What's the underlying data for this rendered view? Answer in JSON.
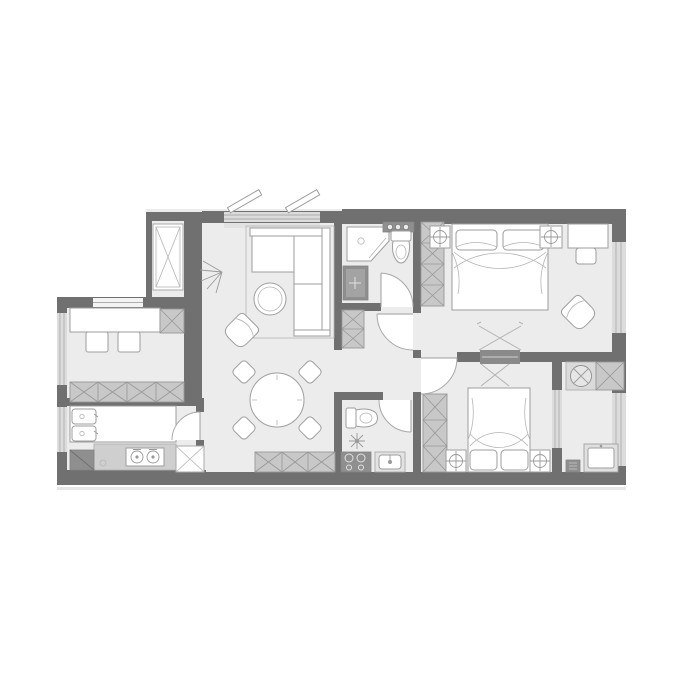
{
  "meta": {
    "title": "Apartment floor plan",
    "description": "Grayscale top-view architectural floor plan of a two-bedroom, two-bathroom apartment with living-dining area, study, kitchen and laundry balcony",
    "visible_text": []
  },
  "palette": {
    "background": "#ffffff",
    "wall": "#707070",
    "floor": "#ececec",
    "furniture_fill": "#ffffff",
    "furniture_stroke": "#9e9e9e",
    "cabinet_hatch_fill": "#c8c8c8",
    "cabinet_hatch_stroke": "#979797",
    "window_fill": "#dcdcdc",
    "window_line": "#adadad",
    "fixture_dark": "#8f8f8f",
    "counter_gray": "#cfcfcf"
  },
  "rooms": [
    {
      "id": "living-room",
      "position": "top-center-left",
      "furniture": [
        "corner-sofa",
        "coffee-table",
        "armchair",
        "floor-lamp",
        "casement-window-open-leaves"
      ]
    },
    {
      "id": "dining-area",
      "position": "center",
      "furniture": [
        "round-dining-table",
        "dining-chair-x4",
        "sideboard-hatched-cabinet"
      ]
    },
    {
      "id": "study",
      "position": "middle-left",
      "furniture": [
        "desk",
        "chair-x2",
        "desk-end-cabinet",
        "storage-cabinet-row"
      ]
    },
    {
      "id": "kitchen",
      "position": "bottom-left",
      "furniture": [
        "double-sink",
        "upper-counter",
        "lower-counter",
        "two-burner-cooktop",
        "corner-cabinet",
        "fridge-cabinet",
        "door"
      ]
    },
    {
      "id": "entry-closet",
      "position": "top-left",
      "furniture": [
        "tall-wardrobe-x-cabinet"
      ]
    },
    {
      "id": "bathroom-1",
      "position": "top-center",
      "furniture": [
        "corner-shower",
        "toilet",
        "vanity-washbasin",
        "wash-counter-with-bowls",
        "door"
      ]
    },
    {
      "id": "bedroom-1",
      "position": "top-right",
      "furniture": [
        "double-bed",
        "nightstand-with-lamp-x2",
        "hatched-wardrobe",
        "desk",
        "desk-chair",
        "lounge-chair",
        "ceiling-light-cross"
      ]
    },
    {
      "id": "bedroom-2",
      "position": "bottom-center-right",
      "furniture": [
        "double-bed",
        "nightstand-with-lamp-x2",
        "hatched-wardrobe",
        "ceiling-light-cross"
      ]
    },
    {
      "id": "bathroom-2",
      "position": "bottom-center",
      "furniture": [
        "toilet",
        "shower-head-symbol",
        "vanity-washbasin",
        "dark-appliance-with-knobs",
        "door"
      ]
    },
    {
      "id": "balcony-laundry",
      "position": "right",
      "furniture": [
        "mop-sink-cabinet",
        "hatched-storage-cell",
        "washing-machine",
        "utility-box",
        "sliding-window"
      ]
    }
  ],
  "counts": {
    "bedrooms": 2,
    "bathrooms": 2,
    "interior-doors": 5,
    "windows": 7
  }
}
